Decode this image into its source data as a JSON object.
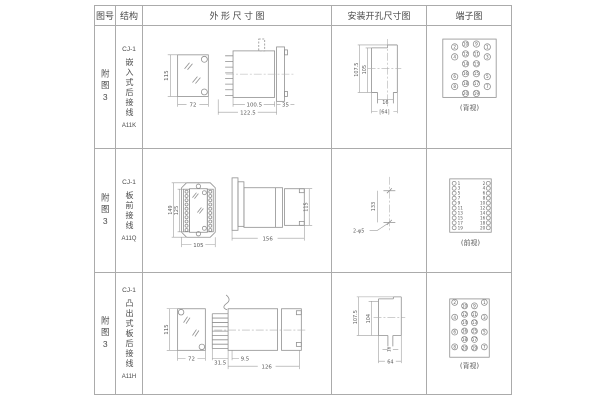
{
  "header": {
    "figure": "图号",
    "structure": "结构",
    "outline": "外 形 尺 寸 图",
    "mounting": "安装开孔尺寸图",
    "terminal": "端子图"
  },
  "rows": [
    {
      "figure": "附图3",
      "model": "CJ-1",
      "structure": "嵌入式后接线",
      "code": "A11K",
      "outline_dims": {
        "front_height": "115",
        "front_width": "72",
        "body_length": "100.5",
        "overall_length": "122.5",
        "flange_depth": "35"
      },
      "mounting_dims": {
        "outer_height": "107.5",
        "inner_height": "105",
        "slot_width": "16",
        "overall_width": "[64]"
      },
      "terminal": {
        "view_label": "(背视)",
        "outer_left": [
          "2",
          "4",
          "6",
          "8"
        ],
        "inner_left": [
          "10",
          "12",
          "14",
          "16",
          "18",
          "20"
        ],
        "inner_right": [
          "9",
          "11",
          "13",
          "15",
          "17",
          "19"
        ],
        "outer_right": [
          "1",
          "3",
          "5",
          "7"
        ]
      }
    },
    {
      "figure": "附图3",
      "model": "CJ-1",
      "structure": "板前接线",
      "code": "A11Q",
      "outline_dims": {
        "front_height": "149",
        "inner_height": "125",
        "front_width": "105",
        "side_length": "156",
        "side_height": "115"
      },
      "mounting_dims": {
        "hole_spacing": "133",
        "hole_note": "2-φ5"
      },
      "terminal": {
        "view_label": "(前视)",
        "left": [
          "1",
          "3",
          "5",
          "7",
          "9",
          "11",
          "13",
          "15",
          "17",
          "19"
        ],
        "right": [
          "2",
          "4",
          "6",
          "8",
          "10",
          "12",
          "14",
          "16",
          "18",
          "20"
        ]
      }
    },
    {
      "figure": "附图3",
      "model": "CJ-1",
      "structure": "凸出式板后接线",
      "code": "A11H",
      "outline_dims": {
        "front_height": "115",
        "front_width": "72",
        "comb_depth": "31.5",
        "offset": "9.5",
        "body_length": "126"
      },
      "mounting_dims": {
        "outer_height": "107.5",
        "inner_height": "104",
        "slot_width": "16",
        "overall_width": "64"
      },
      "terminal": {
        "view_label": "(背视)",
        "outer_left": [
          "2",
          "4",
          "6",
          "8"
        ],
        "inner_left": [
          "10",
          "12",
          "14",
          "16",
          "18",
          "20"
        ],
        "inner_right": [
          "9",
          "11",
          "13",
          "15",
          "17",
          "19"
        ],
        "outer_right": [
          "1",
          "3",
          "5",
          "7"
        ]
      }
    }
  ]
}
